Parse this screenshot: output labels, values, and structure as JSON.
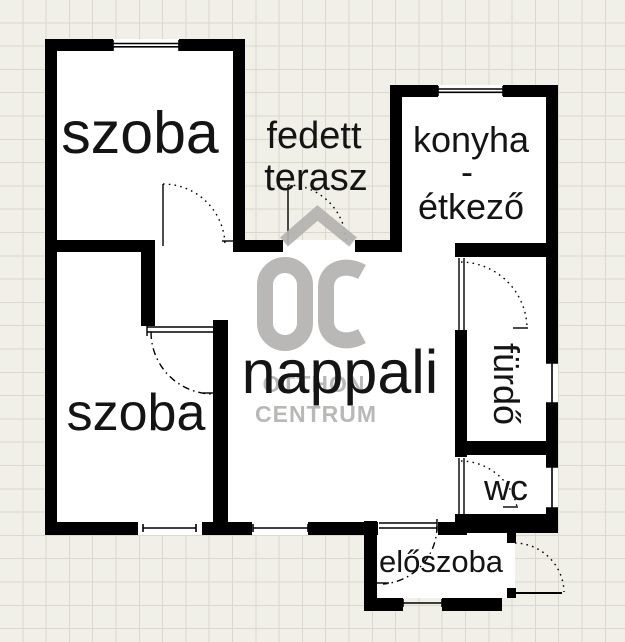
{
  "rooms": {
    "szoba_top": "szoba",
    "szoba_bottom": "szoba",
    "terasz_line1": "fedett",
    "terasz_line2": "terasz",
    "konyha_line1": "konyha",
    "konyha_line2": "-",
    "konyha_line3": "étkező",
    "nappali": "nappali",
    "furdo": "fürdő",
    "wc": "wc",
    "eloszoba": "előszoba"
  },
  "watermark": {
    "logo_text": "OC",
    "name_line1": "OTTHON",
    "name_line2": "CENTRUM"
  },
  "colors": {
    "wall": "#000000",
    "floor": "#ffffff",
    "paper": "#f0efe8",
    "grid_line": "#dcd8cb",
    "watermark": "#b4b3b0",
    "label_text": "#141414"
  }
}
